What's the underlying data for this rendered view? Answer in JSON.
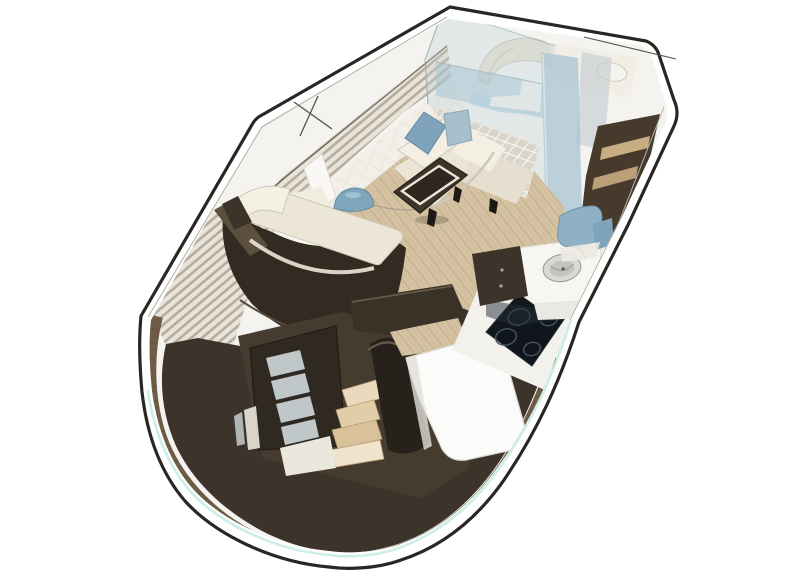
{
  "scene": {
    "type": "3d-interior-rendering",
    "subject": "Motor yacht main-deck interior cutaway: salon settee, galley with cooktop and sink, chaise console, companionway stairs going below, aft bench",
    "view": "isometric aerial cutaway",
    "background": "#ffffff",
    "width_px": 811,
    "height_px": 573
  },
  "objects": [
    "hull-shell",
    "deck-rim",
    "windshield-glass",
    "bow-berth",
    "glass-partition",
    "sliding-glass-door",
    "port-window-blinds",
    "quilted-wall",
    "salon-settee",
    "throw-pillow-blue",
    "throw-pillow-gray",
    "wine-rack-lattice",
    "coffee-table",
    "chaise-lounge",
    "decor-bowl",
    "salon-wood-floor",
    "deck-wood-ring",
    "cockpit-sole",
    "companionway-stairs",
    "companionway-door",
    "stair-landing",
    "aft-bench",
    "galley-counter",
    "galley-sink",
    "galley-faucet",
    "induction-cooktop",
    "galley-cabinet",
    "starboard-cabinet",
    "cabinet-shelves",
    "seat-cushion-blue"
  ],
  "colors": {
    "background": "#ffffff",
    "hull_line": "#2a2622",
    "inner_line": "#b8b4ac",
    "rim_cyan": "#cdeee6",
    "base": "#f4f3ef",
    "slat_light": "#e9e4d9",
    "slat_dark": "#b0a798",
    "slat_trim": "#6a635a",
    "quilt_wall": "#f1efe8",
    "quilt_line": "#d9d4c6",
    "pillar": "#f8f7f3",
    "glass": "#bfd0d8",
    "glass_edge": "#9aacb4",
    "glass_box": "#9ec0d2",
    "glass_box_top": "#b7d4e2",
    "mullion": "#9fc0d2",
    "mullion_hi": "#e8f2f6",
    "window_band": "#c6cdd1",
    "berth_cream": "#e7e2d3",
    "berth_cream2": "#f1eee5",
    "berth_line": "#cfc8b8",
    "berth_pillow": "#f6f4ee",
    "bar_white": "#f0f1ee",
    "wood": "#d5c2a2",
    "wood_streak": "#bca67f",
    "ring_wood": "#6e5c47",
    "ring_streak": "#5a4a38",
    "sole": "#3c342a",
    "lattice_bg": "#d9d5ca",
    "lattice_line": "#ffffff",
    "cushion": "#ebe5d6",
    "cushion2": "#e6dfd0",
    "cushion_hi": "#f3efe3",
    "cushion_edge": "#cfc8b6",
    "pillow_blue": "#7fa3bd",
    "pillow_blue_edge": "#6588a0",
    "pillow_gray": "#a8bfcc",
    "pillow_gray_edge": "#8ba6b5",
    "table_wood": "#3e342a",
    "table_frame": "#ece6d8",
    "table_center": "#2e2720",
    "table_leg": "#1d1915",
    "chaise_pad": "#ece6d7",
    "chaise_back": "#f4f0e4",
    "chaise_slab": "#f0ece0",
    "console": "#332b22",
    "console_hi": "#564a3a",
    "console_trim": "#5d4f3e",
    "bowl_blue": "#7ea6bd",
    "bowl_hi": "#a9c8d8",
    "stair_wall": "#453b2e",
    "door": "#2f2921",
    "door_glass": "#ccd5d8",
    "step1": "#ead9bd",
    "step2": "#e2cda9",
    "step3": "#d9c29a",
    "step4": "#efe3cc",
    "step_edge": "#b49c74",
    "landing": "#eae7dd",
    "stair_dark": "#27211b",
    "stair_hi": "#6b5d4b",
    "transom": "#3a3127",
    "transom_edge": "#6e5e49",
    "bench": "#fbfbf9",
    "bench_edge": "#dcdad3",
    "bench_shade": "#e2e0d8",
    "counter": "#f7f6f3",
    "counter_side": "#e9e8e4",
    "counter_edge": "#dedcd4",
    "surround": "#f2f1ec",
    "cooktop": "#10161c",
    "cooktop_edge": "#232e36",
    "burner": "#46565f",
    "sink_rim": "#d8d8d4",
    "sink_bowl": "#c2c4c2",
    "sink_line": "#97978f",
    "faucet": "#8a8a88",
    "cab_dark": "#3c332a",
    "cab_mid": "#453a2c",
    "knob": "#a9a49c",
    "shelf_tan": "#c8ad83",
    "shelf_tan2": "#bb9f77",
    "seat_blue": "#8fb1c5",
    "seat_blue_edge": "#6f93a9",
    "seat_blue2": "#7fa3ba",
    "white_sliver": "#eceae2",
    "accent_line": "#57534c",
    "shadow": "#3a342c"
  }
}
